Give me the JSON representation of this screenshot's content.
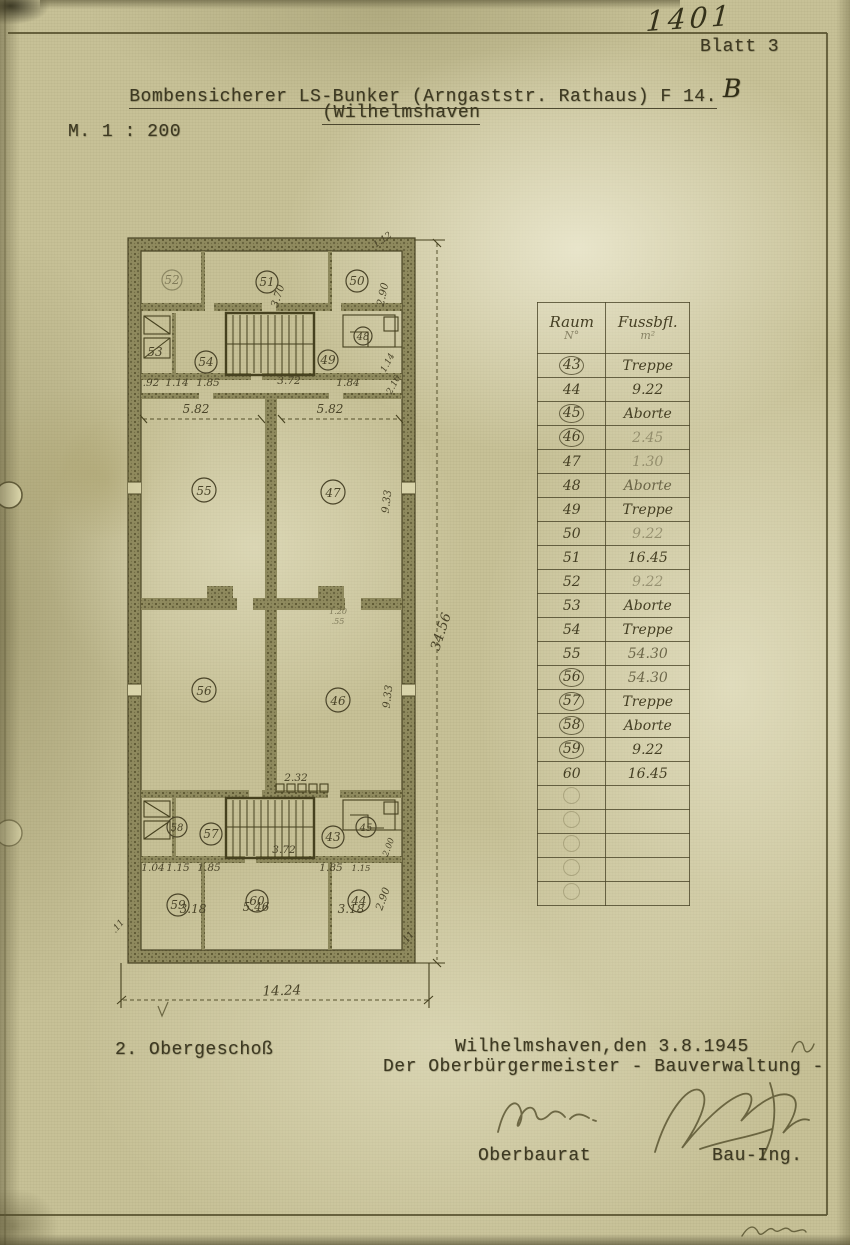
{
  "page": {
    "sheet_number": "1401",
    "sheet_label": "Blatt 3",
    "title_line1": "Bombensicherer LS-Bunker (Arngaststr. Rathaus) F 14.",
    "title_annotation": "B",
    "title_line2": "(Wilhelmshaven",
    "scale": "M. 1 : 200"
  },
  "plan": {
    "floor_label": "2. Obergeschoß",
    "room_numbers": {
      "43": "43",
      "44": "44",
      "45": "45",
      "46": "46",
      "47": "47",
      "48": "48",
      "49": "49",
      "50": "50",
      "51": "51",
      "52": "52",
      "53": "53",
      "54": "54",
      "55": "55",
      "56": "56",
      "57": "57",
      "58": "58",
      "59": "59",
      "60": "60"
    },
    "dims": {
      "total_width": "14.24",
      "total_height": "34.56",
      "big_room_width": "5.82",
      "big_room_height": "9.33",
      "stair_width": "3.72",
      "vent_width": "2.32",
      "corner_room_width": "3.18",
      "center_room_width": "5.46",
      "corner_room_height": "2.90",
      "top_center_depth": "3.70",
      "seg_92": ".92",
      "seg_114": "1.14",
      "seg_185": "1.85",
      "seg_184": "1.84",
      "seg_104": "1.04",
      "seg_115": "1.15",
      "seg_112": "1.12",
      "seg_216": "2.16",
      "seg_120": "1.20",
      "seg_55": ".55",
      "seg_11": ".11",
      "seg_200": "2.00"
    }
  },
  "table": {
    "header": {
      "col1_line1": "Raum",
      "col1_line2": "N°",
      "col2_line1": "Fussbfl.",
      "col2_line2": "m²"
    },
    "rows": [
      {
        "room": "43",
        "value": "Treppe",
        "circled": true,
        "faint": false
      },
      {
        "room": "44",
        "value": "9.22",
        "circled": false,
        "faint": false
      },
      {
        "room": "45",
        "value": "Aborte",
        "circled": true,
        "faint": false
      },
      {
        "room": "46",
        "value": "2.45",
        "circled": true,
        "faint": true
      },
      {
        "room": "47",
        "value": "1.30",
        "circled": false,
        "faint": true
      },
      {
        "room": "48",
        "value": "Aborte",
        "circled": false,
        "faint": false
      },
      {
        "room": "49",
        "value": "Treppe",
        "circled": false,
        "faint": false
      },
      {
        "room": "50",
        "value": "9.22",
        "circled": false,
        "faint": true
      },
      {
        "room": "51",
        "value": "16.45",
        "circled": false,
        "faint": false
      },
      {
        "room": "52",
        "value": "9.22",
        "circled": false,
        "faint": true
      },
      {
        "room": "53",
        "value": "Aborte",
        "circled": false,
        "faint": false
      },
      {
        "room": "54",
        "value": "Treppe",
        "circled": false,
        "faint": false
      },
      {
        "room": "55",
        "value": "54.30",
        "circled": false,
        "faint": false
      },
      {
        "room": "56",
        "value": "54.30",
        "circled": true,
        "faint": false
      },
      {
        "room": "57",
        "value": "Treppe",
        "circled": true,
        "faint": false
      },
      {
        "room": "58",
        "value": "Aborte",
        "circled": true,
        "faint": false
      },
      {
        "room": "59",
        "value": "9.22",
        "circled": true,
        "faint": false
      },
      {
        "room": "60",
        "value": "16.45",
        "circled": false,
        "faint": false
      }
    ],
    "empty_row_count": 5
  },
  "footer": {
    "place_date": "Wilhelmshaven,den 3.8.1945",
    "authority": "Der Oberbürgermeister - Bauverwaltung -",
    "role_left": "Oberbaurat",
    "role_right": "Bau-Ing."
  },
  "colors": {
    "paper": "#c7c197",
    "ink": "#3d3922",
    "pencil": "#4a4429",
    "wall": "#8f8a5e"
  }
}
